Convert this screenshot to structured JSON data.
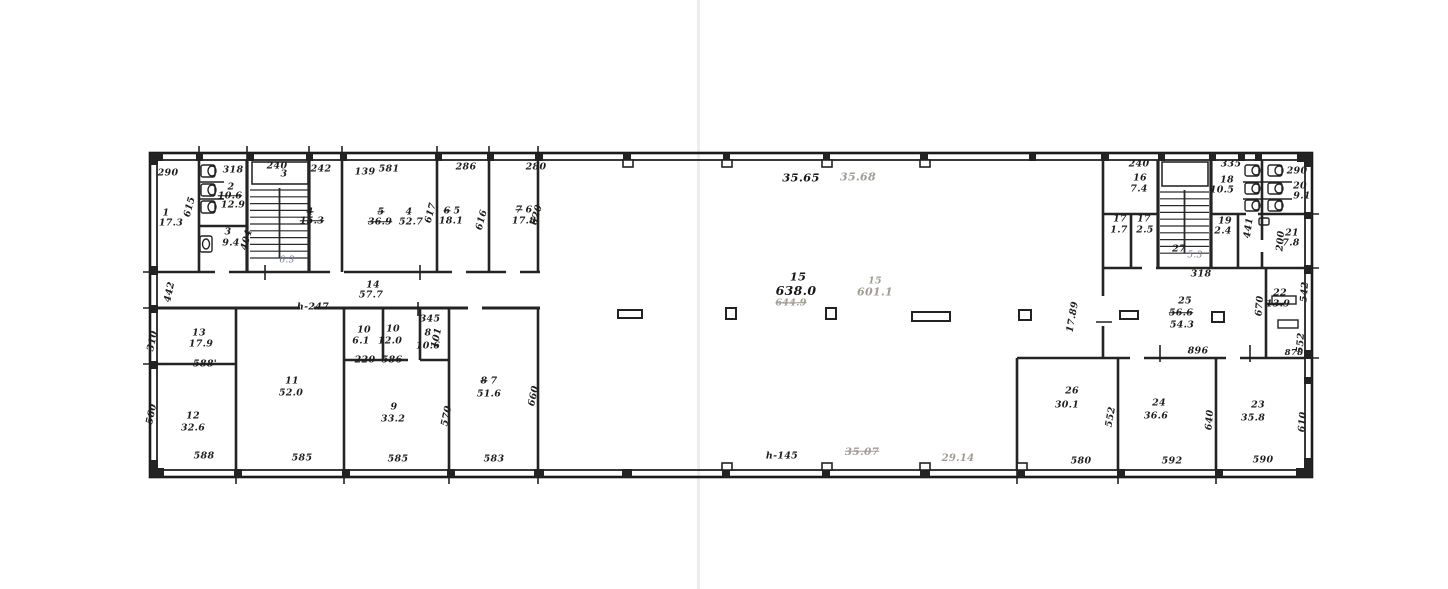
{
  "plan": {
    "drawing_type": "scanned building floor plan",
    "colors": {
      "ink": "#1f1e1c",
      "faint_pencil": "#a29c91",
      "handwriting": "#6d7d9d",
      "paper": "#ffffff"
    },
    "labels": [
      {
        "t": "290",
        "x": 168,
        "y": 173
      },
      {
        "t": "1",
        "x": 166,
        "y": 213
      },
      {
        "t": "17.3",
        "x": 171,
        "y": 223
      },
      {
        "t": "615",
        "x": 190,
        "y": 207,
        "r": -75
      },
      {
        "t": "318",
        "x": 233,
        "y": 170
      },
      {
        "t": "2",
        "x": 231,
        "y": 187
      },
      {
        "t": "10.6",
        "x": 230,
        "y": 196,
        "c": "s"
      },
      {
        "t": "12.9",
        "x": 233,
        "y": 205
      },
      {
        "t": "3",
        "x": 228,
        "y": 232
      },
      {
        "t": "9.4",
        "x": 231,
        "y": 243
      },
      {
        "t": "404",
        "x": 247,
        "y": 240,
        "r": -75
      },
      {
        "t": "240",
        "x": 277,
        "y": 166
      },
      {
        "t": "3",
        "x": 284,
        "y": 174
      },
      {
        "t": "6.3",
        "x": 287,
        "y": 261,
        "c": "h"
      },
      {
        "t": "242",
        "x": 321,
        "y": 169
      },
      {
        "t": "4",
        "x": 310,
        "y": 212,
        "c": "s"
      },
      {
        "t": "15.3",
        "x": 312,
        "y": 221,
        "c": "s"
      },
      {
        "t": "139",
        "x": 365,
        "y": 172
      },
      {
        "t": "581",
        "x": 389,
        "y": 169
      },
      {
        "t": "5",
        "x": 381,
        "y": 212,
        "c": "s"
      },
      {
        "t": "36.9",
        "x": 380,
        "y": 222,
        "c": "s"
      },
      {
        "t": "4",
        "x": 409,
        "y": 212
      },
      {
        "t": "52.7",
        "x": 411,
        "y": 222
      },
      {
        "t": "617",
        "x": 431,
        "y": 213,
        "r": -75
      },
      {
        "t": "286",
        "x": 466,
        "y": 167
      },
      {
        "t": "6",
        "x": 447,
        "y": 211,
        "c": "s"
      },
      {
        "t": "5",
        "x": 457,
        "y": 211
      },
      {
        "t": "18.1",
        "x": 451,
        "y": 221
      },
      {
        "t": "616",
        "x": 482,
        "y": 220,
        "r": -75
      },
      {
        "t": "280",
        "x": 536,
        "y": 167
      },
      {
        "t": "7",
        "x": 519,
        "y": 210,
        "c": "s"
      },
      {
        "t": "6",
        "x": 529,
        "y": 210
      },
      {
        "t": "17.8",
        "x": 524,
        "y": 221
      },
      {
        "t": "620",
        "x": 537,
        "y": 215,
        "r": -75
      },
      {
        "t": "14",
        "x": 373,
        "y": 285
      },
      {
        "t": "57.7",
        "x": 371,
        "y": 295
      },
      {
        "t": "h-247",
        "x": 313,
        "y": 307
      },
      {
        "t": "442",
        "x": 170,
        "y": 292,
        "r": -78
      },
      {
        "t": "345",
        "x": 430,
        "y": 319
      },
      {
        "t": "13",
        "x": 199,
        "y": 333
      },
      {
        "t": "17.9",
        "x": 201,
        "y": 344
      },
      {
        "t": "310",
        "x": 153,
        "y": 341,
        "r": -78
      },
      {
        "t": "588'",
        "x": 205,
        "y": 364
      },
      {
        "t": "12",
        "x": 193,
        "y": 416
      },
      {
        "t": "32.6",
        "x": 193,
        "y": 428
      },
      {
        "t": "560",
        "x": 152,
        "y": 414,
        "r": -78
      },
      {
        "t": "588",
        "x": 204,
        "y": 456
      },
      {
        "t": "11",
        "x": 292,
        "y": 381
      },
      {
        "t": "52.0",
        "x": 291,
        "y": 393
      },
      {
        "t": "585",
        "x": 302,
        "y": 458
      },
      {
        "t": "10",
        "x": 364,
        "y": 330
      },
      {
        "t": "6.1",
        "x": 361,
        "y": 341
      },
      {
        "t": "220",
        "x": 365,
        "y": 360
      },
      {
        "t": "10",
        "x": 393,
        "y": 329
      },
      {
        "t": "12.0",
        "x": 390,
        "y": 341
      },
      {
        "t": "586",
        "x": 392,
        "y": 360
      },
      {
        "t": "8",
        "x": 428,
        "y": 333
      },
      {
        "t": "10.6",
        "x": 428,
        "y": 346
      },
      {
        "t": "101",
        "x": 437,
        "y": 338,
        "r": -78
      },
      {
        "t": "9",
        "x": 394,
        "y": 407
      },
      {
        "t": "33.2",
        "x": 393,
        "y": 419
      },
      {
        "t": "585",
        "x": 398,
        "y": 459
      },
      {
        "t": "570",
        "x": 447,
        "y": 416,
        "r": -78
      },
      {
        "t": "8",
        "x": 484,
        "y": 381,
        "c": "s"
      },
      {
        "t": "7",
        "x": 494,
        "y": 381
      },
      {
        "t": "51.6",
        "x": 489,
        "y": 394
      },
      {
        "t": "660",
        "x": 534,
        "y": 396,
        "r": -78
      },
      {
        "t": "583",
        "x": 494,
        "y": 459
      },
      {
        "t": "35.65",
        "x": 801,
        "y": 178,
        "c": "pb"
      },
      {
        "t": "35.68",
        "x": 858,
        "y": 177,
        "c": "f",
        "s": 11
      },
      {
        "t": "15",
        "x": 798,
        "y": 277,
        "c": "pb"
      },
      {
        "t": "638.0",
        "x": 796,
        "y": 291,
        "c": "pb",
        "s": 12.5
      },
      {
        "t": "644.9",
        "x": 791,
        "y": 303,
        "c": "fs"
      },
      {
        "t": "15",
        "x": 875,
        "y": 281,
        "c": "f"
      },
      {
        "t": "601.1",
        "x": 875,
        "y": 292,
        "c": "f",
        "s": 11
      },
      {
        "t": "h-145",
        "x": 782,
        "y": 456
      },
      {
        "t": "35.07",
        "x": 862,
        "y": 452,
        "c": "fs",
        "s": 10.5
      },
      {
        "t": "29.14",
        "x": 958,
        "y": 459,
        "c": "f",
        "s": 10
      },
      {
        "t": "17.89",
        "x": 1073,
        "y": 317,
        "r": -80
      },
      {
        "t": "240",
        "x": 1139,
        "y": 164
      },
      {
        "t": "16",
        "x": 1140,
        "y": 178
      },
      {
        "t": "7.4",
        "x": 1139,
        "y": 189
      },
      {
        "t": "17",
        "x": 1120,
        "y": 219
      },
      {
        "t": "1.7",
        "x": 1119,
        "y": 230
      },
      {
        "t": "17",
        "x": 1144,
        "y": 219
      },
      {
        "t": "2.5",
        "x": 1145,
        "y": 230
      },
      {
        "t": "27",
        "x": 1179,
        "y": 249
      },
      {
        "t": "5.3",
        "x": 1195,
        "y": 256,
        "c": "h"
      },
      {
        "t": "318",
        "x": 1201,
        "y": 274
      },
      {
        "t": "335",
        "x": 1231,
        "y": 164
      },
      {
        "t": "18",
        "x": 1227,
        "y": 180
      },
      {
        "t": "10.5",
        "x": 1222,
        "y": 190
      },
      {
        "t": "19",
        "x": 1225,
        "y": 221
      },
      {
        "t": "2.4",
        "x": 1223,
        "y": 231
      },
      {
        "t": "441",
        "x": 1249,
        "y": 228,
        "r": -82
      },
      {
        "t": "290",
        "x": 1297,
        "y": 171
      },
      {
        "t": "20",
        "x": 1300,
        "y": 186
      },
      {
        "t": "9.1",
        "x": 1302,
        "y": 196
      },
      {
        "t": "21",
        "x": 1292,
        "y": 233
      },
      {
        "t": "7.8",
        "x": 1291,
        "y": 243
      },
      {
        "t": "200",
        "x": 1281,
        "y": 241,
        "r": -85
      },
      {
        "t": "25",
        "x": 1185,
        "y": 301
      },
      {
        "t": "56.6",
        "x": 1181,
        "y": 313,
        "c": "s"
      },
      {
        "t": "54.3",
        "x": 1182,
        "y": 325
      },
      {
        "t": "896",
        "x": 1198,
        "y": 351
      },
      {
        "t": "670",
        "x": 1260,
        "y": 306,
        "r": -85
      },
      {
        "t": "22",
        "x": 1280,
        "y": 293
      },
      {
        "t": "13.9",
        "x": 1278,
        "y": 304
      },
      {
        "t": "542",
        "x": 1305,
        "y": 292,
        "r": -85
      },
      {
        "t": "552",
        "x": 1301,
        "y": 343,
        "r": -85
      },
      {
        "t": "878",
        "x": 1294,
        "y": 353,
        "s": 8.5
      },
      {
        "t": "26",
        "x": 1072,
        "y": 391
      },
      {
        "t": "30.1",
        "x": 1067,
        "y": 405
      },
      {
        "t": "580",
        "x": 1081,
        "y": 461
      },
      {
        "t": "552",
        "x": 1111,
        "y": 417,
        "r": -80
      },
      {
        "t": "24",
        "x": 1159,
        "y": 403
      },
      {
        "t": "36.6",
        "x": 1156,
        "y": 416
      },
      {
        "t": "592",
        "x": 1172,
        "y": 461
      },
      {
        "t": "640",
        "x": 1210,
        "y": 420,
        "r": -85
      },
      {
        "t": "23",
        "x": 1258,
        "y": 405
      },
      {
        "t": "35.8",
        "x": 1253,
        "y": 418
      },
      {
        "t": "590",
        "x": 1263,
        "y": 460
      },
      {
        "t": "610",
        "x": 1303,
        "y": 422,
        "r": -85
      }
    ]
  }
}
